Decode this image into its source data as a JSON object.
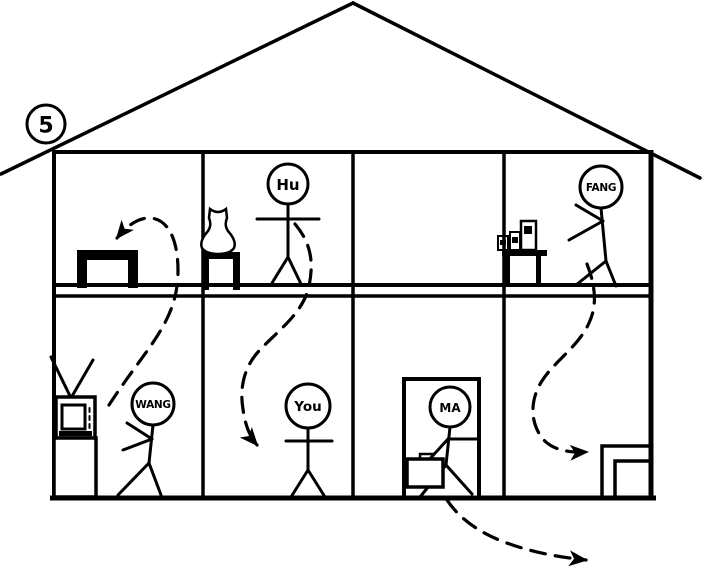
{
  "item_number": "5",
  "colors": {
    "ink": "#000000",
    "background": "#ffffff"
  },
  "house": {
    "floors": 2,
    "rooms_per_floor": 4,
    "roof": "pitched"
  },
  "people": [
    {
      "id": "hu",
      "label": "Hu",
      "floor": "upstairs",
      "room_from_left": 2,
      "pose": "standing, arms out"
    },
    {
      "id": "fang",
      "label": "FANG",
      "floor": "upstairs",
      "room_from_left": 4,
      "pose": "walking left"
    },
    {
      "id": "wang",
      "label": "WANG",
      "floor": "downstairs",
      "room_from_left": 1,
      "pose": "walking left"
    },
    {
      "id": "you",
      "label": "You",
      "floor": "downstairs",
      "room_from_left": 2,
      "pose": "standing, arms out"
    },
    {
      "id": "ma",
      "label": "MA",
      "floor": "downstairs",
      "room_from_left": 3,
      "pose": "standing in doorway with briefcase"
    }
  ],
  "furniture": [
    {
      "name": "picture-frame",
      "floor": "upstairs",
      "room_from_left": 1
    },
    {
      "name": "vase-on-stool",
      "floor": "upstairs",
      "room_from_left": 2
    },
    {
      "name": "shelf-with-books",
      "floor": "upstairs",
      "room_from_left": 4
    },
    {
      "name": "tv-on-stand",
      "floor": "downstairs",
      "room_from_left": 1
    },
    {
      "name": "doorway",
      "floor": "downstairs",
      "room_from_left": 3
    },
    {
      "name": "corner-cabinet",
      "floor": "downstairs",
      "room_from_left": 4
    }
  ],
  "movement_arrows": [
    {
      "from": "Wang (downstairs room 1)",
      "to": "upstairs room 1 (picture frame)",
      "style": "dashed"
    },
    {
      "from": "Hu (upstairs room 2)",
      "to": "downstairs room 2 (You's room)",
      "style": "dashed"
    },
    {
      "from": "Fang (upstairs room 4)",
      "to": "downstairs room 4 (corner cabinet)",
      "style": "dashed"
    },
    {
      "from": "Ma (downstairs doorway)",
      "to": "outside the house, lower right",
      "style": "dashed"
    }
  ]
}
